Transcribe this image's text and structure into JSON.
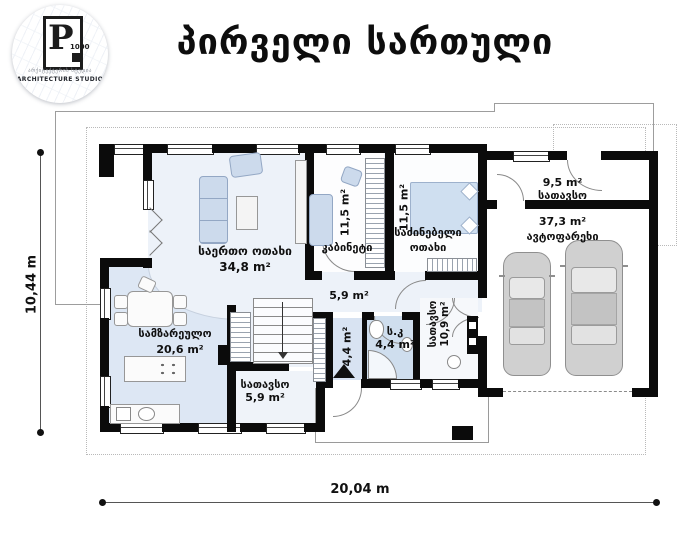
{
  "title": "პირველი სართული",
  "logo": {
    "mark": "P",
    "mark_number": "1000",
    "studio_line_georgian": "არქიტექტურის სტუდია",
    "studio_line": "ARCHITECTURE STUDIO"
  },
  "dimensions": {
    "vertical": "10,44 m",
    "horizontal": "20,04 m"
  },
  "rooms": {
    "living": {
      "name": "საერთო ოთახი",
      "area": "34,8 m²"
    },
    "cabinet": {
      "name": "კაბინეტი",
      "area": "11,5 m²"
    },
    "bedroom": {
      "name_line1": "საძინებელი",
      "name_line2": "ოთახი",
      "area": "11,5 m²"
    },
    "storage_top": {
      "name": "სათავსო",
      "area": "9,5 m²"
    },
    "garage": {
      "name": "ავტოფარეხი",
      "area": "37,3 m²"
    },
    "kitchen": {
      "name": "სამზარეულო",
      "area": "20,6 m²"
    },
    "storage_small": {
      "name": "სათავსო",
      "area": "5,9 m²"
    },
    "hall": {
      "area": "5,9 m²"
    },
    "vestibule": {
      "area": "4,4 m²"
    },
    "wc": {
      "name": "ს.კ",
      "area": "4,4 m²"
    },
    "utility": {
      "name": "სათავსო",
      "area": "10,9 m²"
    }
  }
}
